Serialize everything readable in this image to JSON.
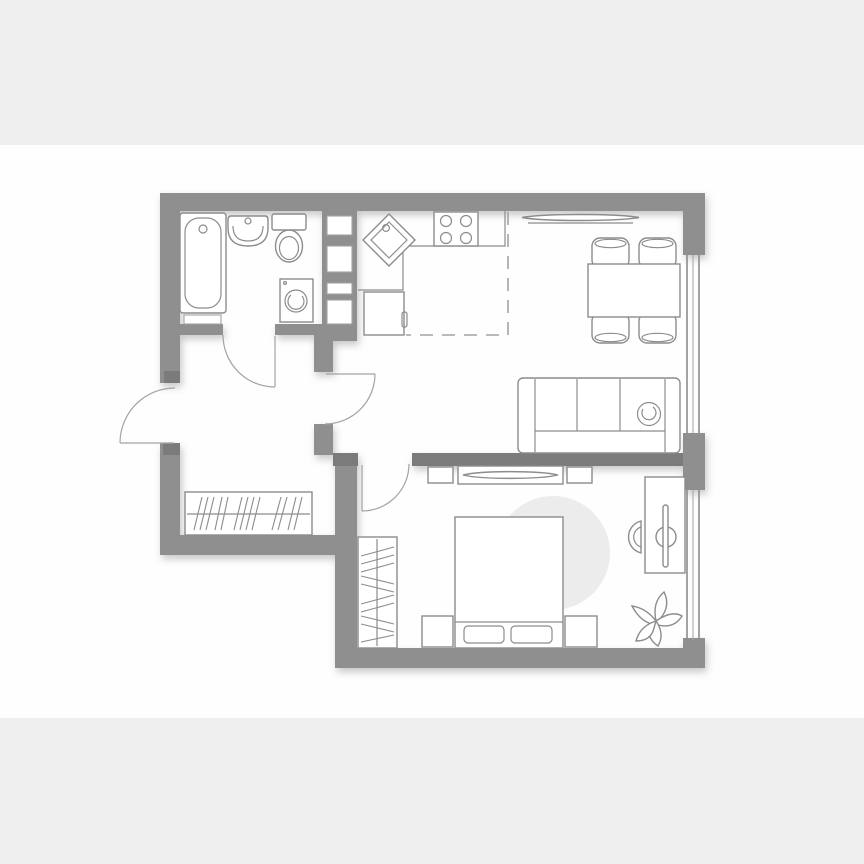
{
  "page": {
    "width": 864,
    "height": 864,
    "band_top_height": 145,
    "band_bottom_top": 718
  },
  "palette": {
    "band": "#efefef",
    "floor": "#fefefe",
    "wall": "#8f8f8f",
    "wall_dark": "#7b7b7b",
    "outline": "#8c8c8c",
    "outline_light": "#a3a3a3",
    "rug": "#ececec",
    "fixture_fill": "#ffffff"
  },
  "plan": {
    "type": "one-bedroom-apartment-floor-plan",
    "rooms": [
      {
        "name": "bathroom",
        "furniture": [
          "bathtub",
          "bath-shelf",
          "wash-basin",
          "toilet",
          "washing-machine"
        ]
      },
      {
        "name": "kitchen",
        "furniture": [
          "corner-counter",
          "diagonal-sink",
          "stove-four-burners",
          "fridge",
          "kitchen-zone-dashed-boundary",
          "duct-shaft"
        ]
      },
      {
        "name": "living-dining",
        "furniture": [
          "wall-tv",
          "dining-table",
          "dining-chairs-x4",
          "sofa-three-seat",
          "sofa-throw"
        ]
      },
      {
        "name": "hallway",
        "furniture": [
          "wardrobe-with-hanging-rail"
        ]
      },
      {
        "name": "bedroom",
        "furniture": [
          "round-rug",
          "double-bed",
          "pillows-x2",
          "nightstand-left",
          "nightstand-right",
          "wardrobe-with-hanging-rail",
          "tv-console",
          "speaker-left",
          "speaker-right",
          "tv-lens",
          "desk",
          "desk-chair",
          "monitor",
          "plant"
        ]
      }
    ],
    "doors": [
      "entry-door",
      "bathroom-door",
      "living-room-door",
      "bedroom-door"
    ],
    "windows": [
      "living-room-window",
      "bedroom-window"
    ]
  }
}
